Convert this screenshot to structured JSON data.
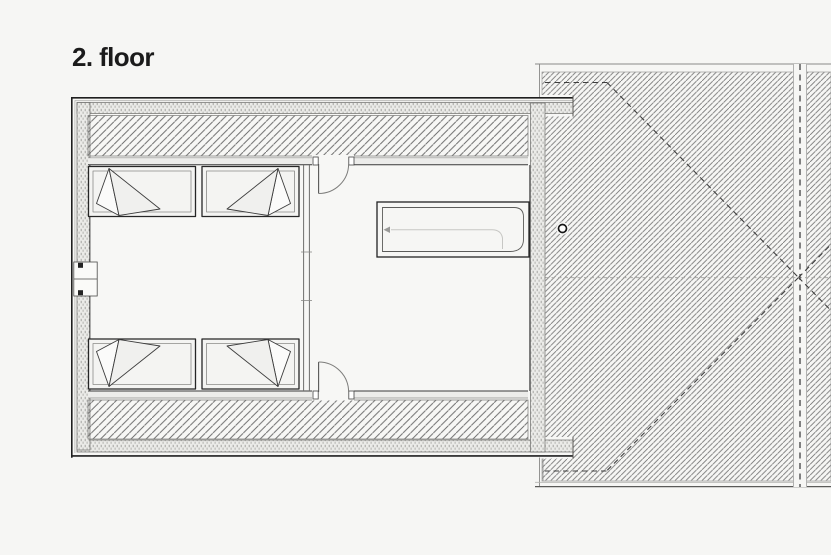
{
  "title": "2. floor",
  "colors": {
    "background": "#f6f6f4",
    "paper": "#f7f7f5",
    "line_dark": "#1f1f1f",
    "line_medium": "#555555",
    "line_light": "#9a9a98",
    "hatch_wall": "#6d6d6d",
    "hatch_roof": "#757575",
    "dash_dark": "#3e3e3e",
    "dash_light": "#ababa8",
    "title_color": "#1b1b1b"
  }
}
